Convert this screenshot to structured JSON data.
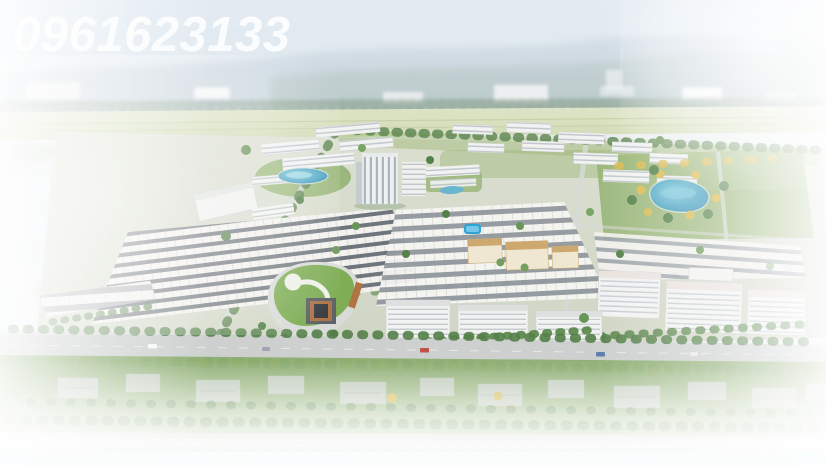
{
  "watermark": {
    "text": "0961623133",
    "color": "#ffffff",
    "style": "italic-bold-white"
  },
  "scene": {
    "type": "aerial-3d-masterplan-render",
    "subject": "bird's-eye 3D rendering of a planned residential township surrounded by an existing town, hazy mountains on the horizon, edges faded to white",
    "elements": [
      "hazy-sky",
      "mountain-range",
      "distant-city-skyline",
      "farmland-band",
      "green-belt",
      "townhouse-rows",
      "apartment-blocks",
      "highrise-tower",
      "school-campus",
      "shopping-mall-green-roof",
      "central-pond",
      "landscape-lake",
      "swimming-pool",
      "internal-roads",
      "main-boulevard",
      "street-trees",
      "existing-neighborhood",
      "white-vignette-edges"
    ]
  },
  "palette": {
    "sky": "#d5e3ee",
    "mountain_haze": "#aebfce",
    "farmland": "#d4ddb6",
    "project_lawn": "#8cae66",
    "tree_green": "#557f47",
    "tree_yellow": "#d8b94a",
    "lake_blue": "#3a93ba",
    "pool_blue": "#27a0d2",
    "road_gray": "#cccfcd",
    "building_white": "#f2f3f1",
    "roof_dark": "#6b7076",
    "mall_roof_green": "#79aa4e",
    "beige_complex": "#c79e5f",
    "vignette": "#ffffff"
  }
}
